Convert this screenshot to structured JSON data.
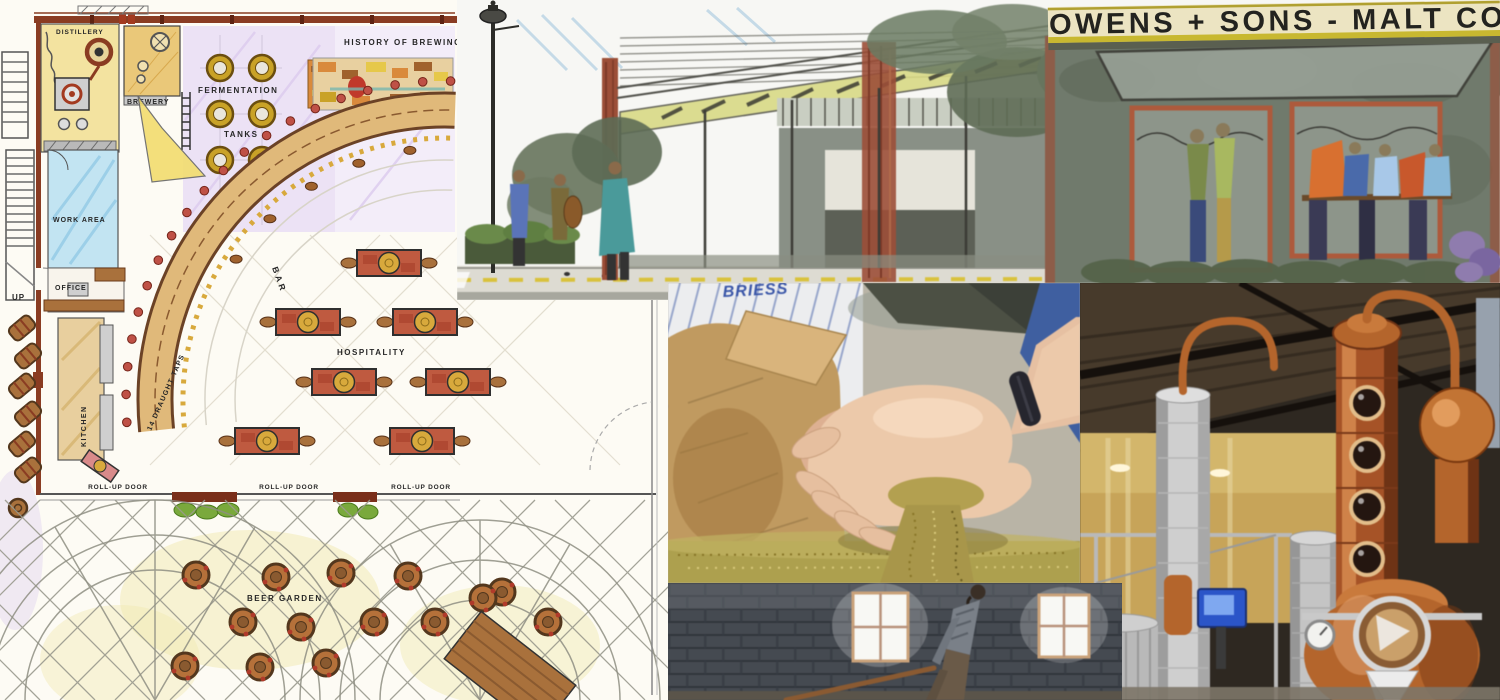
{
  "floor_plan": {
    "labels": {
      "distillery": "DISTILLERY",
      "brewery": "BREWERY",
      "fermentation": "FERMENTATION",
      "tanks": "TANKS",
      "history_of_brewing": "HISTORY OF BREWING",
      "malting": "MALTING",
      "work_area": "WORK AREA",
      "office": "OFFICE",
      "up": "UP",
      "kitchen": "KITCHEN",
      "bar": "BAR",
      "draught_taps": "14 DRAUGHT TAPS",
      "hospitality": "HOSPITALITY",
      "roll_up_door": "ROLL-UP DOOR",
      "beer_garden": "BEER GARDEN"
    }
  },
  "sketch": {
    "sign": "OWENS + SONS - MALT CO"
  },
  "photos": {
    "malt_hands": {
      "bag_brand": "BRIESS"
    },
    "malting_floor": {
      "description": "worker raking malting floor"
    },
    "distillery_stills": {
      "description": "copper distillation stills"
    }
  },
  "colors": {
    "plan_paper": "#fdfbf4",
    "wall_brick": "#8a3c22",
    "tank_gold": "#c9a227",
    "table_red": "#bf5a40",
    "bar_band": "#e0b97a",
    "sign_cream": "#ece4c2",
    "sign_text": "#23231f",
    "copper": "#b4652c",
    "grain": "#b3a050",
    "brick_wall_dark": "#454a51"
  }
}
